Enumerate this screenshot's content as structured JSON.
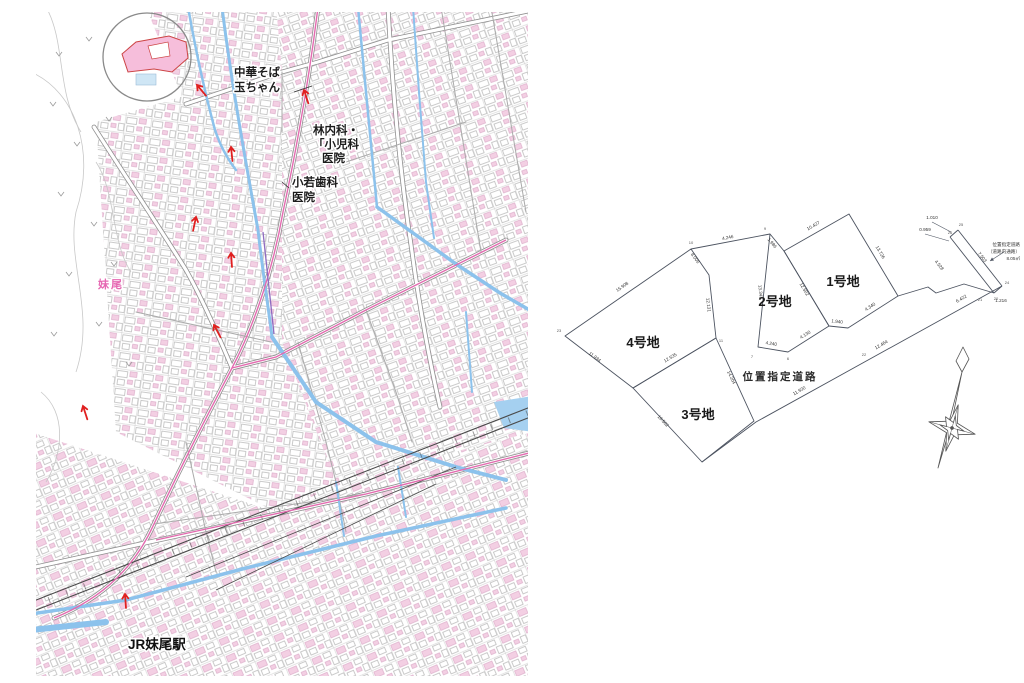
{
  "map": {
    "labels": {
      "ramen_1": "中華そば",
      "ramen_2": "玉ちゃん",
      "clinic_1": "林内科・",
      "clinic_2": "「小児科",
      "clinic_3": "医院",
      "dental_1": "小若歯科",
      "dental_2": "医院",
      "district": "妹尾",
      "station": "JR妹尾駅"
    },
    "red_arrows": [
      {
        "x": 161,
        "y": 73,
        "a": -40
      },
      {
        "x": 268,
        "y": 78,
        "a": -18
      },
      {
        "x": 195,
        "y": 135,
        "a": -6
      },
      {
        "x": 160,
        "y": 205,
        "a": 12
      },
      {
        "x": 195,
        "y": 241,
        "a": -4
      },
      {
        "x": 178,
        "y": 313,
        "a": -28
      },
      {
        "x": 47,
        "y": 394,
        "a": -18
      },
      {
        "x": 89,
        "y": 582,
        "a": -4
      }
    ],
    "colors": {
      "water": "#8cc2ec",
      "route_pink": "#e36bb0",
      "route_purple": "#8f6bc0",
      "building_pink": "#f3cfe3",
      "site_fill": "#f6bedb",
      "site_stroke": "#cc4444",
      "arrow_red": "#e02020"
    }
  },
  "plot_diagram": {
    "parcels": [
      {
        "label": "1号地"
      },
      {
        "label": "2号地"
      },
      {
        "label": "3号地"
      },
      {
        "label": "4号地"
      }
    ],
    "road_label": "位置指定道路",
    "note_lines": [
      "位置指定道路",
      "（道路内通路）",
      "8.05㎡"
    ],
    "dimensions": [
      {
        "t": "10.427",
        "x": 262,
        "y": 27,
        "r": -30
      },
      {
        "t": "13.726",
        "x": 327,
        "y": 53,
        "r": 59
      },
      {
        "t": "1.986",
        "x": 219,
        "y": 44,
        "r": 50
      },
      {
        "t": "13.343",
        "x": 207,
        "y": 92,
        "r": 85
      },
      {
        "t": "12.502",
        "x": 251,
        "y": 90,
        "r": 59
      },
      {
        "t": "4.240",
        "x": 219,
        "y": 145,
        "r": 9
      },
      {
        "t": "4.130",
        "x": 254,
        "y": 136,
        "r": -32
      },
      {
        "t": "1.940",
        "x": 285,
        "y": 123,
        "r": 6
      },
      {
        "t": "4.340",
        "x": 319,
        "y": 108,
        "r": -33
      },
      {
        "t": "15.908",
        "x": 71,
        "y": 88,
        "r": -35
      },
      {
        "t": "8.006",
        "x": 142,
        "y": 59,
        "r": 55
      },
      {
        "t": "4.246",
        "x": 176,
        "y": 39,
        "r": -11
      },
      {
        "t": "12.131",
        "x": 155,
        "y": 105,
        "r": 84
      },
      {
        "t": "12.535",
        "x": 119,
        "y": 159,
        "r": -31
      },
      {
        "t": "11.934",
        "x": 42,
        "y": 158,
        "r": 37
      },
      {
        "t": "16.502",
        "x": 110,
        "y": 222,
        "r": 47
      },
      {
        "t": "14.204",
        "x": 178,
        "y": 178,
        "r": 65
      },
      {
        "t": "12.464",
        "x": 330,
        "y": 146,
        "r": -30
      },
      {
        "t": "11.930",
        "x": 248,
        "y": 192,
        "r": -30
      },
      {
        "t": "6.422",
        "x": 410,
        "y": 100,
        "r": -30
      },
      {
        "t": "7.503",
        "x": 429,
        "y": 58,
        "r": 52
      },
      {
        "t": "4.528",
        "x": 386,
        "y": 66,
        "r": 52
      },
      {
        "t": "1.010",
        "x": 380,
        "y": 19,
        "r": 0
      },
      {
        "t": "0.959",
        "x": 373,
        "y": 31,
        "r": 0
      },
      {
        "t": "1.216",
        "x": 449,
        "y": 102,
        "r": 0
      }
    ],
    "points": [
      {
        "t": "25",
        "x": 409,
        "y": 26
      },
      {
        "t": "26",
        "x": 398,
        "y": 34
      },
      {
        "t": "24",
        "x": 455,
        "y": 84
      },
      {
        "t": "20",
        "x": 444,
        "y": 100
      },
      {
        "t": "9",
        "x": 213,
        "y": 30
      },
      {
        "t": "10",
        "x": 139,
        "y": 44
      },
      {
        "t": "23",
        "x": 7,
        "y": 132
      },
      {
        "t": "7",
        "x": 200,
        "y": 158
      },
      {
        "t": "6",
        "x": 236,
        "y": 160
      },
      {
        "t": "11",
        "x": 169,
        "y": 142
      },
      {
        "t": "22",
        "x": 312,
        "y": 156
      },
      {
        "t": "21",
        "x": 428,
        "y": 101
      }
    ]
  }
}
